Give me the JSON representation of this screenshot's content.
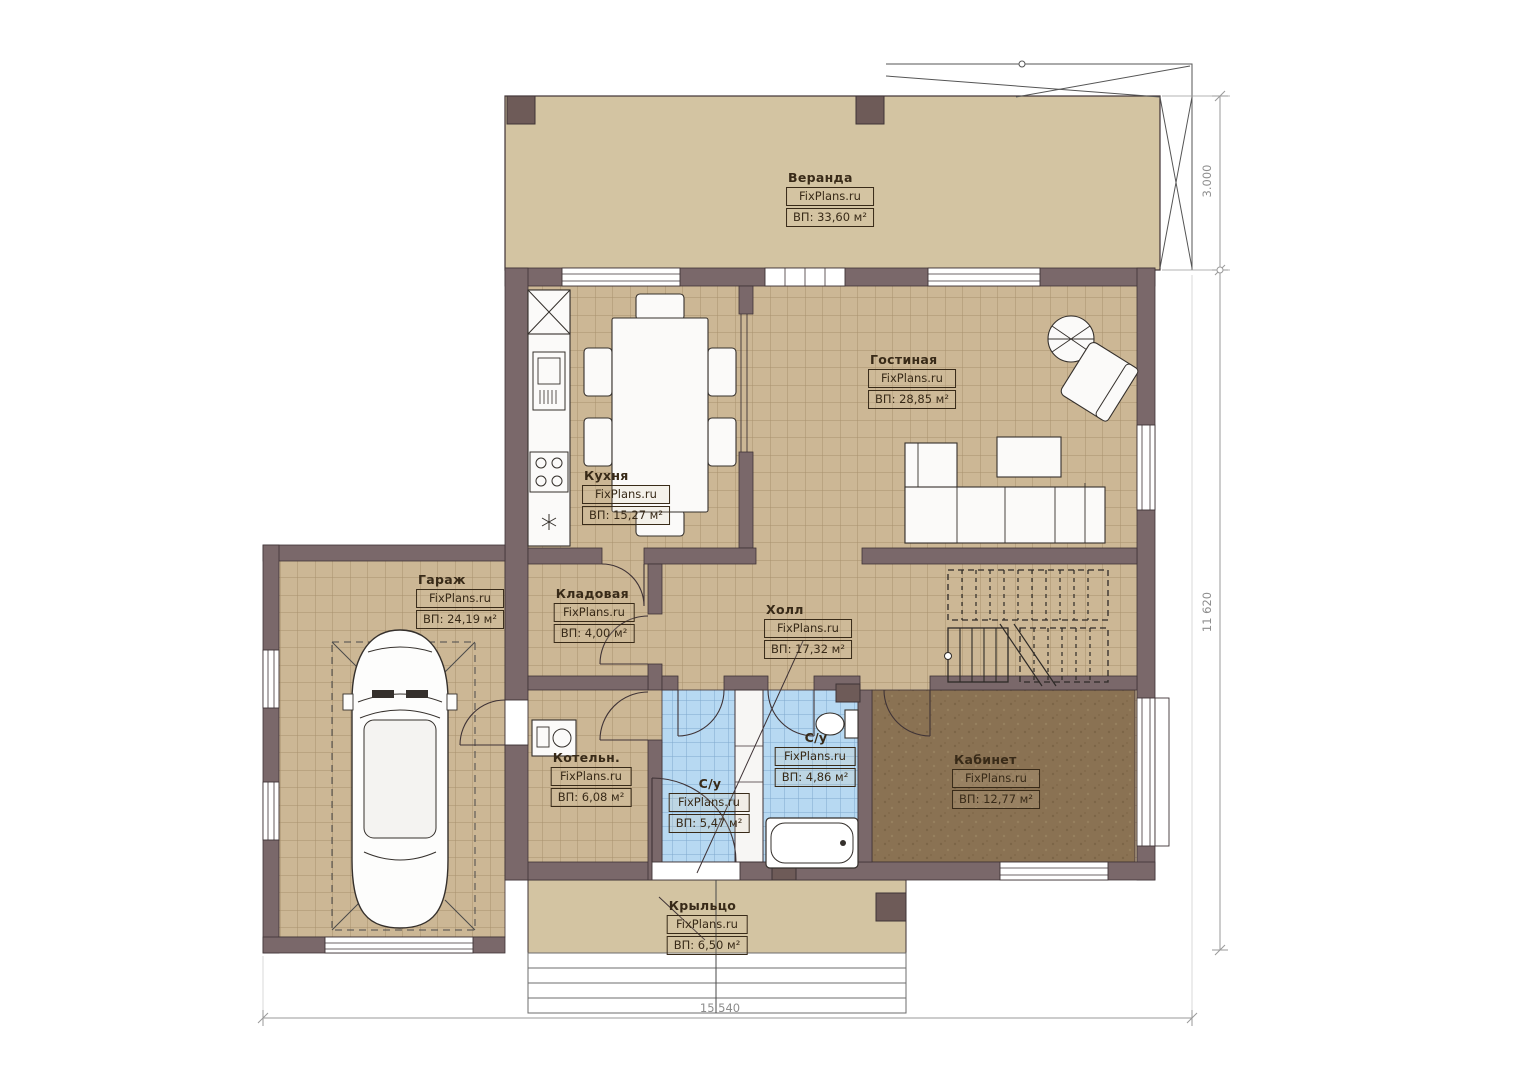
{
  "plan": {
    "watermark": "FixPlans.ru",
    "rooms": [
      {
        "name": "Веранда",
        "watermark": "FixPlans.ru",
        "area": "ВП: 33,60 м²"
      },
      {
        "name": "Гостиная",
        "watermark": "FixPlans.ru",
        "area": "ВП: 28,85 м²"
      },
      {
        "name": "Кухня",
        "watermark": "FixPlans.ru",
        "area": "ВП: 15,27 м²"
      },
      {
        "name": "Гараж",
        "watermark": "FixPlans.ru",
        "area": "ВП: 24,19 м²"
      },
      {
        "name": "Кладовая",
        "watermark": "FixPlans.ru",
        "area": "ВП: 4,00 м²"
      },
      {
        "name": "Холл",
        "watermark": "FixPlans.ru",
        "area": "ВП: 17,32 м²"
      },
      {
        "name": "Котельн.",
        "watermark": "FixPlans.ru",
        "area": "ВП: 6,08 м²"
      },
      {
        "name": "С/у",
        "watermark": "FixPlans.ru",
        "area": "ВП: 5,47 м²"
      },
      {
        "name": "С/у",
        "watermark": "FixPlans.ru",
        "area": "ВП: 4,86 м²"
      },
      {
        "name": "Кабинет",
        "watermark": "FixPlans.ru",
        "area": "ВП: 12,77 м²"
      },
      {
        "name": "Крыльцо",
        "watermark": "FixPlans.ru",
        "area": "ВП: 6,50 м²"
      }
    ],
    "dimensions": {
      "veranda_depth": "3.000",
      "house_side": "11 620",
      "house_front": "15 540"
    },
    "colors": {
      "wall": "#7a686a",
      "floor_tile": "#ccb795",
      "veranda_floor": "#d3c4a2",
      "office_floor": "#8a7253",
      "bath_tile": "#b7d9f2"
    }
  }
}
